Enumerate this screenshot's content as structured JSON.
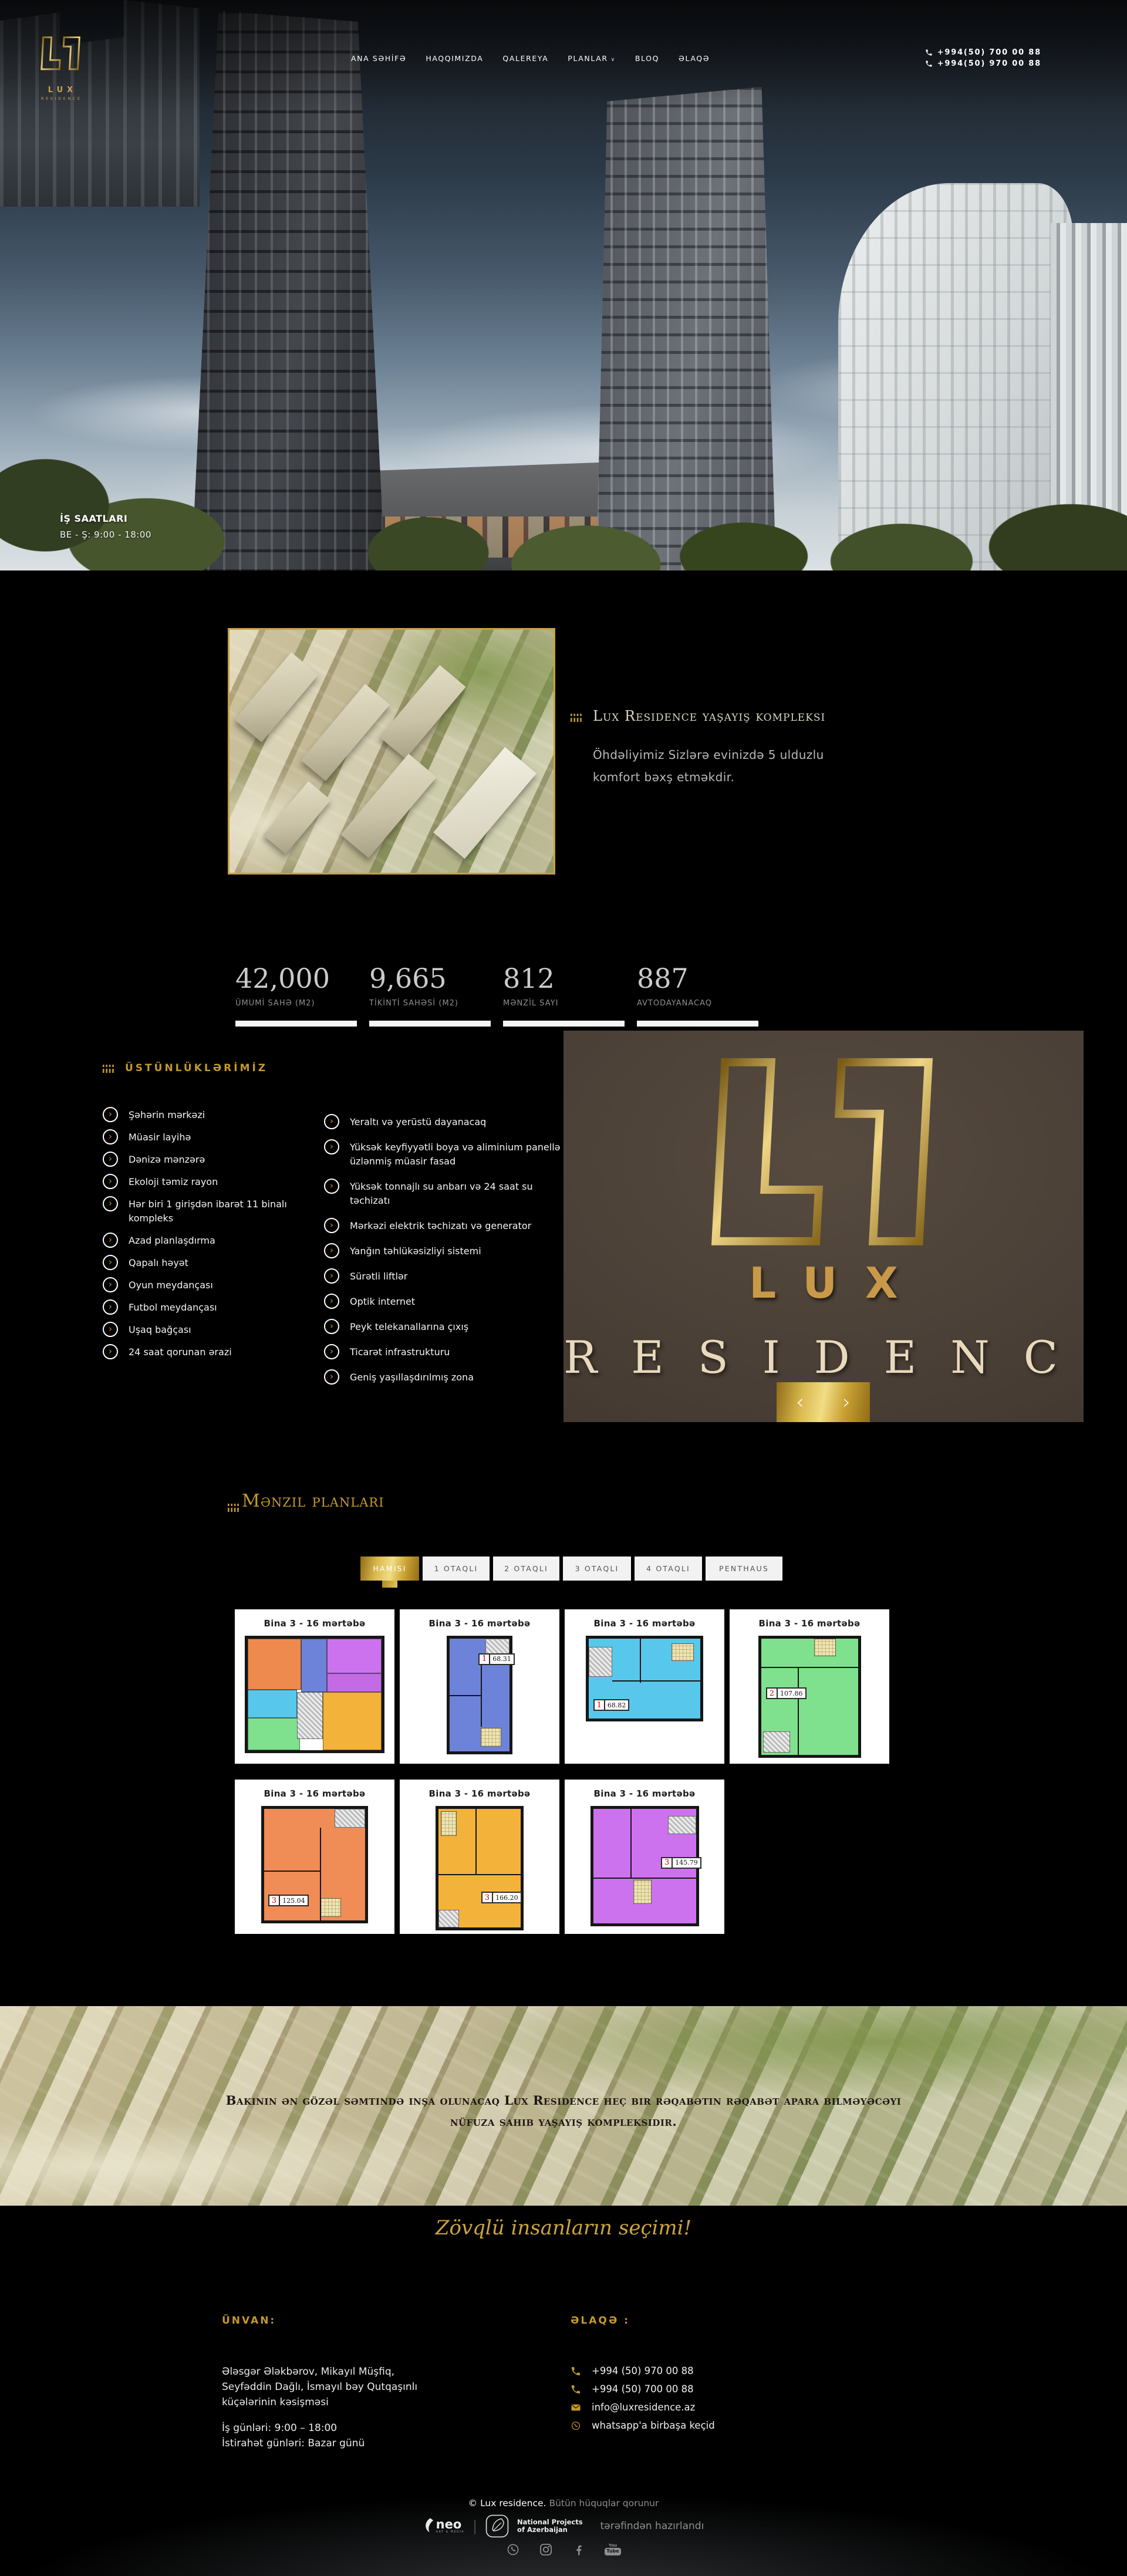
{
  "header": {
    "logo": {
      "brand": "LUX",
      "sub": "RESIDENCE"
    },
    "nav": [
      {
        "label": "ANA SƏHİFƏ",
        "dropdown": false
      },
      {
        "label": "HAQQIMIZDA",
        "dropdown": false
      },
      {
        "label": "QALEREYA",
        "dropdown": false
      },
      {
        "label": "PLANLAR",
        "dropdown": true
      },
      {
        "label": "BLOQ",
        "dropdown": false
      },
      {
        "label": "ƏLAQƏ",
        "dropdown": false
      }
    ],
    "phones": [
      "+994(50) 700 00 88",
      "+994(50) 970 00 88"
    ]
  },
  "hero": {
    "hours_title": "İŞ SAATLARI",
    "hours_value": "BE - Ş: 9:00 - 18:00"
  },
  "about": {
    "title": "Lux Residence yaşayış kompleksi",
    "line1": "Öhdəliyimiz Sizlərə evinizdə 5 ulduzlu",
    "line2": "komfort bəxş etməkdir."
  },
  "stats": [
    {
      "value": "42,000",
      "label": "ÜMUMİ SAHƏ (M2)"
    },
    {
      "value": "9,665",
      "label": "TİKİNTİ SAHƏSİ (M2)"
    },
    {
      "value": "812",
      "label": "MƏNZİL SAYI"
    },
    {
      "value": "887",
      "label": "AVTODAYANACAQ"
    }
  ],
  "advantages": {
    "title": "ÜSTÜNLÜKLƏRİMİZ",
    "left": [
      "Şəhərin mərkəzi",
      "Müasir layihə",
      "Dənizə mənzərə",
      "Ekoloji təmiz rayon",
      "Hər biri 1 girişdən ibarət 11 binalı kompleks",
      "Azad planlaşdırma",
      "Qapalı həyət",
      "Oyun meydançası",
      "Futbol meydançası",
      "Uşaq bağçası",
      "24 saat qorunan ərazi"
    ],
    "right": [
      "Yeraltı və yerüstü dayanacaq",
      "Yüksək keyfiyyətli boya və aliminium panellə üzlənmiş müasir fasad",
      "Yüksək tonnajlı su anbarı və 24 saat su təchizatı",
      "Mərkəzi elektrik təchizatı və generator",
      "Yanğın təhlükəsizliyi sistemi",
      "Sürətli liftlər",
      "Optik internet",
      "Peyk telekanallarına çıxış",
      "Ticarət infrastrukturu",
      "Geniş yaşıllaşdırılmış zona"
    ]
  },
  "logo_panel": {
    "lux": "LUX",
    "residence": "RESIDENCE"
  },
  "plans": {
    "title": "Mənzil planları",
    "tabs": [
      {
        "label": "HAMISI",
        "active": true
      },
      {
        "label": "1 OTAQLI",
        "active": false
      },
      {
        "label": "2 OTAQLI",
        "active": false
      },
      {
        "label": "3 OTAQLI",
        "active": false
      },
      {
        "label": "4 OTAQLI",
        "active": false
      },
      {
        "label": "PENTHAUS",
        "active": false
      }
    ],
    "cards": [
      {
        "title": "Bina 3 - 16 mərtəbə",
        "variant": "full",
        "color": "",
        "unit": "",
        "area": ""
      },
      {
        "title": "Bina 3 - 16 mərtəbə",
        "variant": "tall",
        "color": "#6d83d9",
        "unit": "1",
        "area": "68.31"
      },
      {
        "title": "Bina 3 - 16 mərtəbə",
        "variant": "squat",
        "color": "#57c8ec",
        "unit": "1",
        "area": "68.82"
      },
      {
        "title": "Bina 3 - 16 mərtəbə",
        "variant": "notch",
        "color": "#7fe08d",
        "unit": "2",
        "area": "107.86"
      },
      {
        "title": "Bina 3 - 16 mərtəbə",
        "variant": "wide5",
        "color": "#f08c55",
        "unit": "3",
        "area": "125.04"
      },
      {
        "title": "Bina 3 - 16 mərtəbə",
        "variant": "tall6",
        "color": "#f3b23a",
        "unit": "3",
        "area": "166.20"
      },
      {
        "title": "Bina 3 - 16 mərtəbə",
        "variant": "wide7",
        "color": "#cd72ee",
        "unit": "3",
        "area": "145.79"
      }
    ]
  },
  "banner": {
    "line1": "Bakının ən gözəl səmtində inşa olunacaq Lux Residence heç bir rəqabətin rəqabət apara bilməyəcəyi",
    "line2": "nüfuza sahib yaşayış kompleksidir."
  },
  "tagline": "Zövqlü insanların seçimi!",
  "footer": {
    "address_title": "ÜNVAN:",
    "address_lines": [
      "Ələsgər Ələkbərov, Mikayıl Müşfiq,",
      "Seyfəddin Dağlı, İsmayıl bəy Qutqaşınlı",
      "küçələrinin kəsişməsi"
    ],
    "schedule_lines": [
      "İş günləri: 9:00 – 18:00",
      "İstirahət günləri: Bazar günü"
    ],
    "contact_title": "ƏLAQƏ :",
    "contacts": [
      {
        "icon": "phone-icon",
        "text": "+994 (50) 970 00 88"
      },
      {
        "icon": "phone-icon",
        "text": "+994 (50) 700 00 88"
      },
      {
        "icon": "envelope-icon",
        "text": "info@luxresidence.az"
      },
      {
        "icon": "whatsapp-icon",
        "text": "whatsapp'a birbaşa keçid"
      }
    ]
  },
  "bottom": {
    "copyright_brand": "© Lux residence.",
    "copyright_text": "Bütün hüquqlar qorunur",
    "neo_label": "neo",
    "neo_sub": "ART & MEDIA",
    "np_line1": "National Projects",
    "np_line2": "of Azerbaijan",
    "made_by": "tərəfindən hazırlandı",
    "socials": [
      "whatsapp-icon",
      "instagram-icon",
      "facebook-icon",
      "youtube-icon"
    ]
  },
  "colors": {
    "gold": "#c49a2c",
    "gold_bright": "#f1dd85",
    "panel_brown": "#473d34",
    "plan_khaki": "#efe3b0",
    "plan_multi": [
      "#ee8a4e",
      "#6d83d9",
      "#cd72ee",
      "#c36ae4",
      "#57c8ec",
      "#7fe08d",
      "#f3b23a"
    ]
  }
}
